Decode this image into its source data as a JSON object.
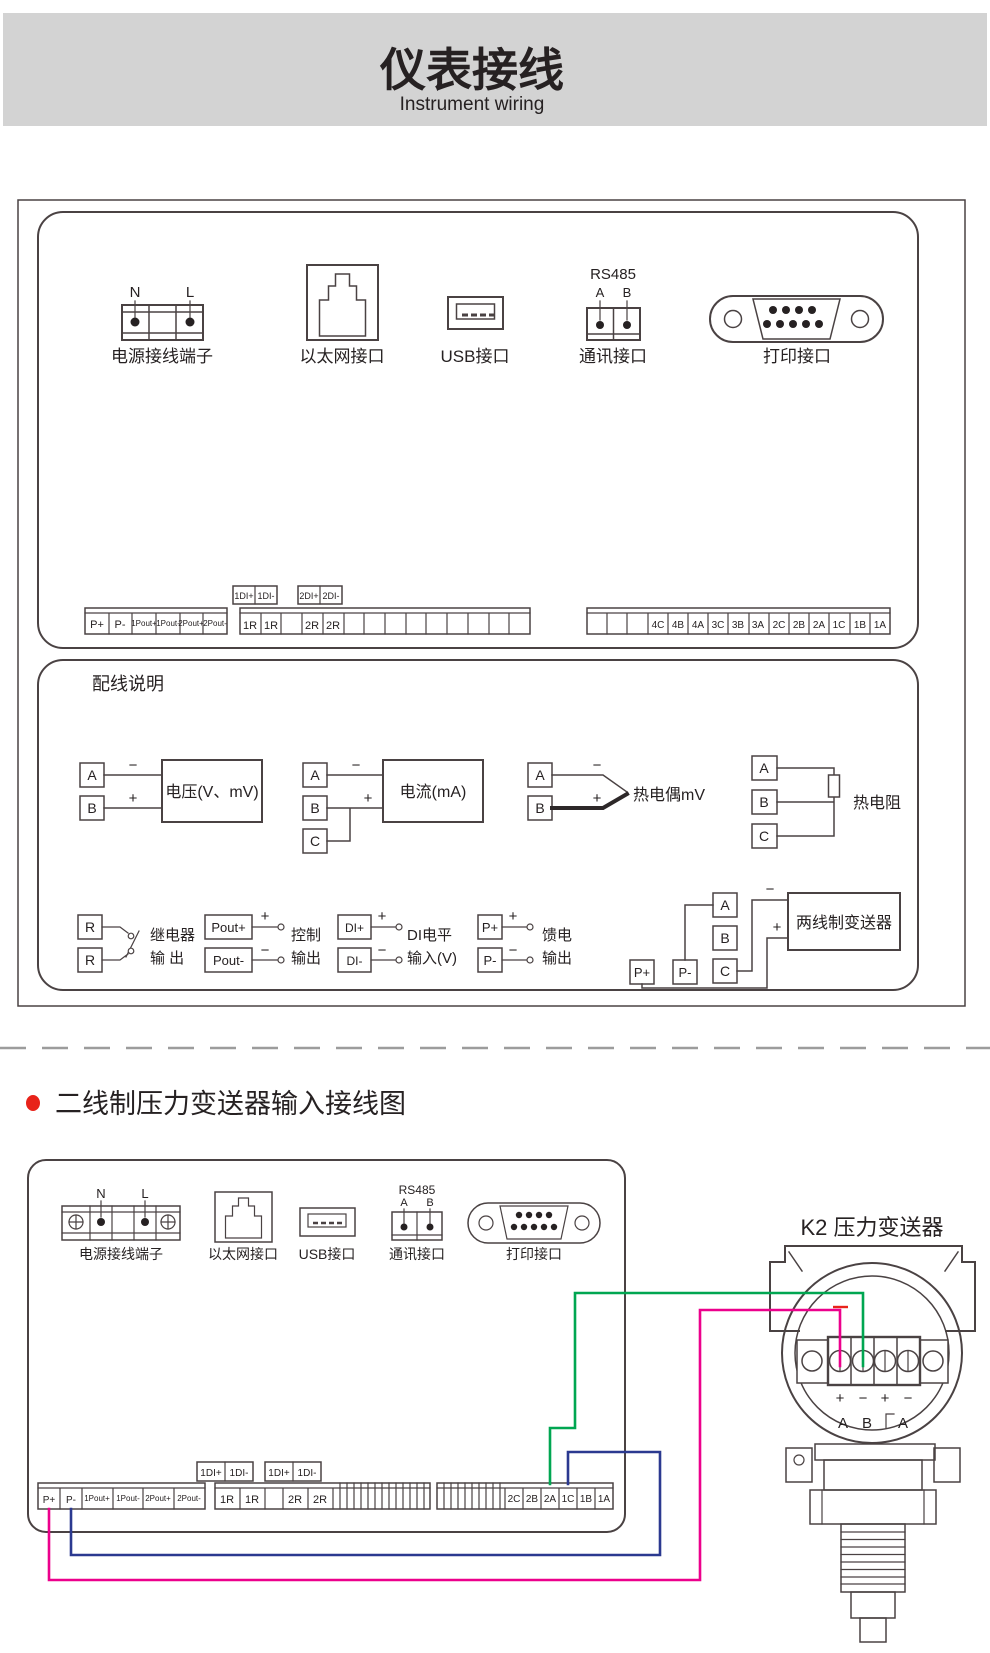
{
  "header": {
    "title": "仪表接线",
    "subtitle": "Instrument wiring"
  },
  "panel1": {
    "ports": {
      "power": {
        "n": "N",
        "l": "L",
        "label": "电源接线端子"
      },
      "ethernet": {
        "label": "以太网接口"
      },
      "usb": {
        "label": "USB接口"
      },
      "rs485": {
        "title": "RS485",
        "a": "A",
        "b": "B",
        "label": "通讯接口"
      },
      "db9": {
        "label": "打印接口"
      }
    },
    "strips": {
      "left": [
        "P+",
        "P-",
        "1Pout+",
        "1Pout-",
        "2Pout+",
        "2Pout-"
      ],
      "di_boxes": [
        [
          "1DI+",
          "1DI-"
        ],
        [
          "2DI+",
          "2DI-"
        ]
      ],
      "middle": [
        "1R",
        "1R",
        "",
        "2R",
        "2R",
        "",
        "",
        "",
        "",
        "",
        "",
        "",
        "",
        ""
      ],
      "right": [
        "",
        "",
        "",
        "4C",
        "4B",
        "4A",
        "3C",
        "3B",
        "3A",
        "2C",
        "2B",
        "2A",
        "1C",
        "1B",
        "1A"
      ]
    }
  },
  "wiring": {
    "title": "配线说明",
    "signs": {
      "plus": "+",
      "minus": "−"
    },
    "voltage": {
      "a": "A",
      "b": "B",
      "label": "电压(V、mV)"
    },
    "current": {
      "a": "A",
      "b": "B",
      "c": "C",
      "label": "电流(mA)"
    },
    "thermocouple": {
      "a": "A",
      "b": "B",
      "label": "热电偶mV"
    },
    "rtd": {
      "a": "A",
      "b": "B",
      "c": "C",
      "label": "热电阻"
    },
    "relay": {
      "r1": "R",
      "r2": "R",
      "line1": "继电器",
      "line2": "输 出"
    },
    "control": {
      "plus": "Pout+",
      "minus": "Pout-",
      "line1": "控制",
      "line2": "输出"
    },
    "di": {
      "plus": "DI+",
      "minus": "DI-",
      "line1": "DI电平",
      "line2": "输入(V)"
    },
    "feed": {
      "plus": "P+",
      "minus": "P-",
      "line1": "馈电",
      "line2": "输出"
    },
    "transmitter2w": {
      "p_plus": "P+",
      "p_minus": "P-",
      "a": "A",
      "b": "B",
      "c": "C",
      "label": "两线制变送器"
    }
  },
  "section2": {
    "title": "二线制压力变送器输入接线图",
    "bullet_color": "#e8231a",
    "panel": {
      "ports": {
        "power": {
          "n": "N",
          "l": "L",
          "label": "电源接线端子"
        },
        "ethernet": {
          "label": "以太网接口"
        },
        "usb": {
          "label": "USB接口"
        },
        "rs485": {
          "title": "RS485",
          "a": "A",
          "b": "B",
          "label": "通讯接口"
        },
        "db9": {
          "label": "打印接口"
        }
      },
      "strips": {
        "left": [
          "P+",
          "P-",
          "1Pout+",
          "1Pout-",
          "2Pout+",
          "2Pout-"
        ],
        "di_boxes": [
          [
            "1DI+",
            "1DI-"
          ],
          [
            "1DI+",
            "1DI-"
          ]
        ],
        "middle": [
          "1R",
          "1R",
          "",
          "2R",
          "2R"
        ],
        "right": [
          "2C",
          "2B",
          "2A",
          "1C",
          "1B",
          "1A"
        ]
      }
    },
    "transmitter": {
      "title": "K2 压力变送器",
      "signs": [
        "+",
        "−",
        "+",
        "−"
      ],
      "letters": [
        "A",
        "B",
        "A"
      ]
    },
    "wires": {
      "supply_magenta": "#ec008c",
      "signal_green": "#00a651",
      "jumper_blue": "#2b3990",
      "mark_red": "#e8231a"
    }
  }
}
